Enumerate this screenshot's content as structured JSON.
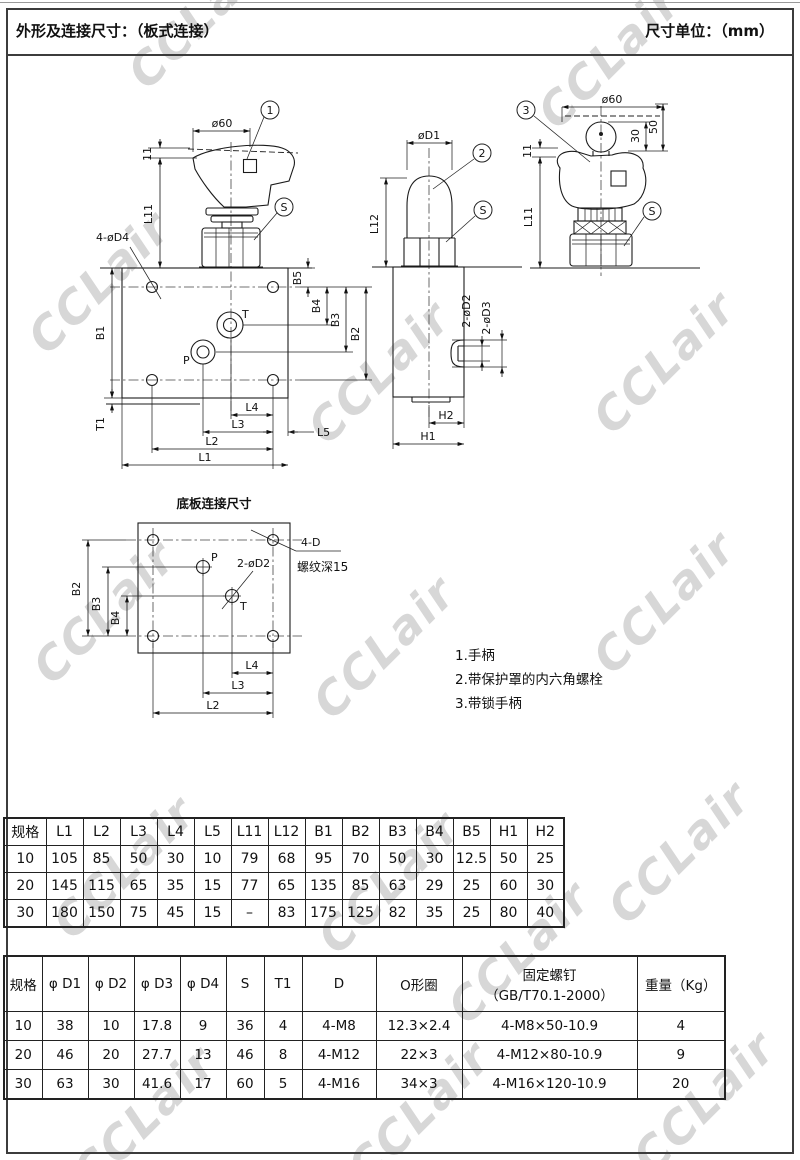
{
  "page": {
    "title_left": "外形及连接尺寸：（板式连接）",
    "title_right": "尺寸单位：（mm）"
  },
  "watermark": {
    "text": "CCLair"
  },
  "drawings": {
    "front": {
      "dia60": "ø60",
      "callout1": "1",
      "callout_s": "S",
      "dim11": "11",
      "l11": "L11",
      "bolt_holes": "4-øD4",
      "port_t": "T",
      "port_p": "P",
      "b1": "B1",
      "b2": "B2",
      "b3": "B3",
      "b4": "B4",
      "b5": "B5",
      "t1": "T1",
      "l1": "L1",
      "l2": "L2",
      "l3": "L3",
      "l4": "L4",
      "l5": "L5"
    },
    "side": {
      "dia_d1": "øD1",
      "callout2": "2",
      "callout_s": "S",
      "l12": "L12",
      "ports_d2": "2-øD2",
      "ports_d3": "2-øD3",
      "h1": "H1",
      "h2": "H2"
    },
    "locked": {
      "dia60": "ø60",
      "callout3": "3",
      "callout_s": "S",
      "dim11": "11",
      "dim30": "30",
      "dim50": "50",
      "l11": "L11"
    },
    "subplate": {
      "title": "底板连接尺寸",
      "port_p": "P",
      "port_t": "T",
      "ports_d2": "2-øD2",
      "thread": "4-D",
      "thread_depth": "螺纹深15",
      "b2": "B2",
      "b3": "B3",
      "b4": "B4",
      "l2": "L2",
      "l3": "L3",
      "l4": "L4"
    }
  },
  "notes": {
    "item1": "1.手柄",
    "item2": "2.带保护罩的内六角螺栓",
    "item3": "3.带锁手柄"
  },
  "tables": {
    "t1": {
      "headers": [
        "规格",
        "L1",
        "L2",
        "L3",
        "L4",
        "L5",
        "L11",
        "L12",
        "B1",
        "B2",
        "B3",
        "B4",
        "B5",
        "H1",
        "H2"
      ],
      "rows": [
        [
          "10",
          "105",
          "85",
          "50",
          "30",
          "10",
          "79",
          "68",
          "95",
          "70",
          "50",
          "30",
          "12.5",
          "50",
          "25"
        ],
        [
          "20",
          "145",
          "115",
          "65",
          "35",
          "15",
          "77",
          "65",
          "135",
          "85",
          "63",
          "29",
          "25",
          "60",
          "30"
        ],
        [
          "30",
          "180",
          "150",
          "75",
          "45",
          "15",
          "–",
          "83",
          "175",
          "125",
          "82",
          "35",
          "25",
          "80",
          "40"
        ]
      ]
    },
    "t2": {
      "headers": [
        "规格",
        "φ D1",
        "φ D2",
        "φ D3",
        "φ D4",
        "S",
        "T1",
        "D",
        "O形圈",
        "固定螺钉\n（GB/T70.1-2000）",
        "重量（Kg）"
      ],
      "rows": [
        [
          "10",
          "38",
          "10",
          "17.8",
          "9",
          "36",
          "4",
          "4-M8",
          "12.3×2.4",
          "4-M8×50-10.9",
          "4"
        ],
        [
          "20",
          "46",
          "20",
          "27.7",
          "13",
          "46",
          "8",
          "4-M12",
          "22×3",
          "4-M12×80-10.9",
          "9"
        ],
        [
          "30",
          "63",
          "30",
          "41.6",
          "17",
          "60",
          "5",
          "4-M16",
          "34×3",
          "4-M16×120-10.9",
          "20"
        ]
      ]
    }
  }
}
